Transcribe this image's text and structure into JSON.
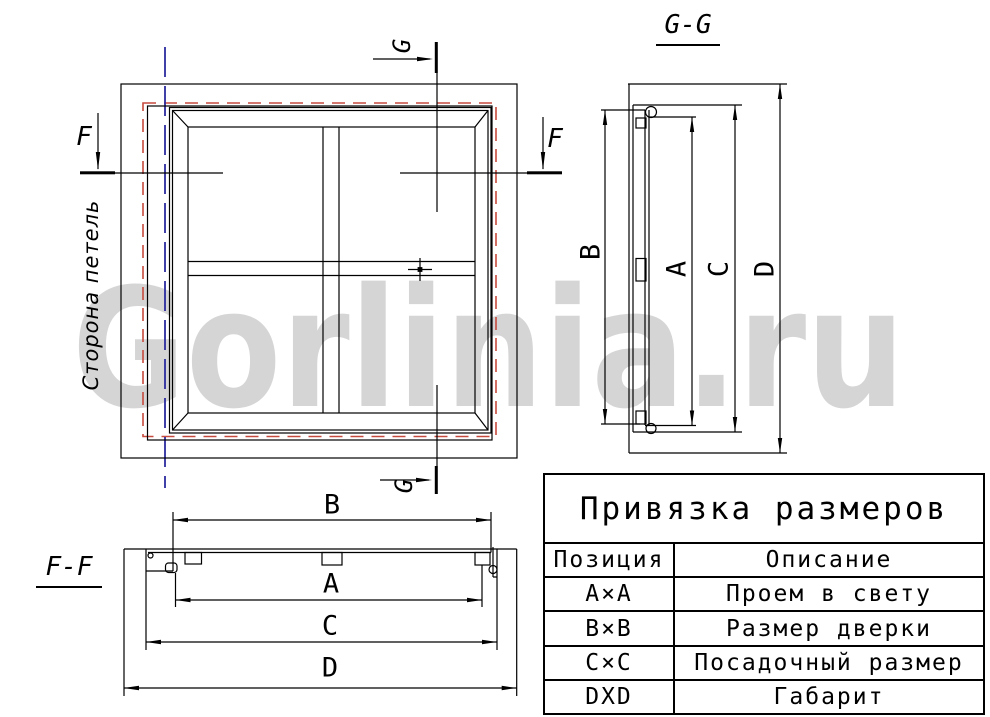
{
  "watermark": "Gorlinia.ru",
  "colors": {
    "line": "#000000",
    "red_dash": "#c64a3e",
    "blue_axis": "#2b2b9e",
    "watermark_gray": "#d5d5d5"
  },
  "front": {
    "hinge_label": "Сторона петель",
    "f": "F",
    "g": "G"
  },
  "gg": {
    "title": "G-G",
    "b": "B",
    "a": "A",
    "c": "C",
    "d": "D"
  },
  "ff": {
    "title": "F-F",
    "b": "B",
    "a": "A",
    "c": "C",
    "d": "D"
  },
  "table": {
    "title": "Привязка размеров",
    "headers": [
      "Позиция",
      "Описание"
    ],
    "rows": [
      [
        "A×A",
        "Проем в свету"
      ],
      [
        "B×B",
        "Размер дверки"
      ],
      [
        "C×C",
        "Посадочный размер"
      ],
      [
        "DXD",
        "Габарит"
      ]
    ]
  }
}
